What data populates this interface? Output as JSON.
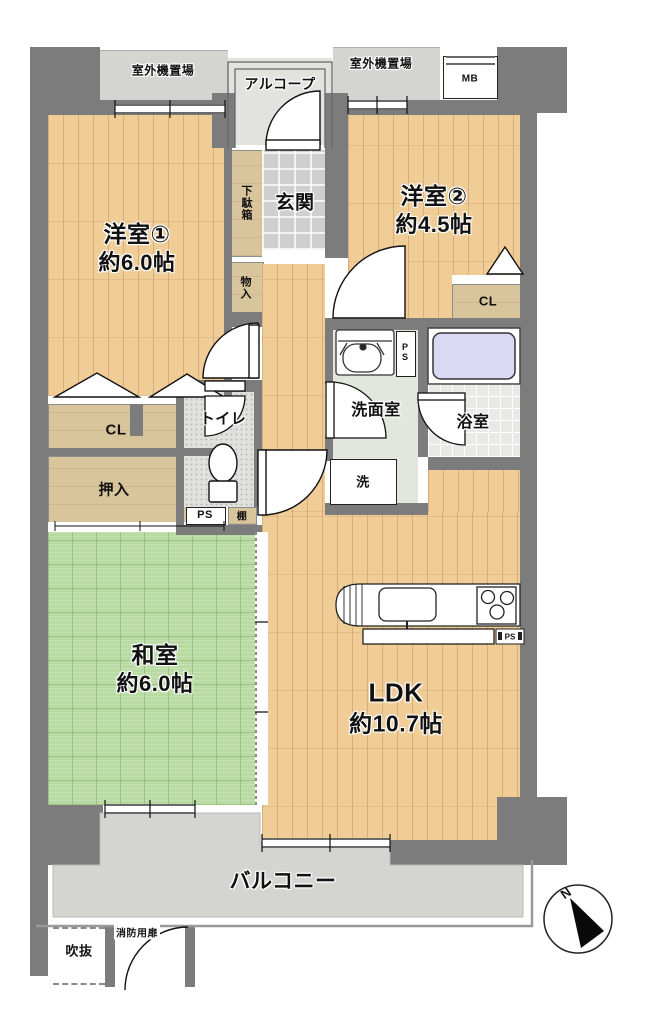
{
  "floorplan": {
    "exterior": {
      "outdoor_unit_left": "室外機置場",
      "outdoor_unit_right": "室外機置場",
      "alcove": "アルコープ",
      "meter_box": "MB",
      "balcony": "バルコニー",
      "open_void": "吹抜",
      "fire_door": "消防用扉"
    },
    "entrance": {
      "genkan": "玄関",
      "shoe_cabinet": "下駄箱",
      "hall_storage": "物入"
    },
    "rooms": {
      "western1": {
        "name": "洋室①",
        "size": "約6.0帖"
      },
      "western2": {
        "name": "洋室②",
        "size": "約4.5帖"
      },
      "japanese": {
        "name": "和室",
        "size": "約6.0帖"
      },
      "ldk": {
        "name": "LDK",
        "size": "約10.7帖"
      }
    },
    "sanitary": {
      "washroom": "洗面室",
      "bathroom": "浴室",
      "toilet": "トイレ",
      "laundry": "洗"
    },
    "storage": {
      "closet_left": "CL",
      "closet_right": "CL",
      "oshiire": "押入",
      "shelf": "棚"
    },
    "pipe_spaces": {
      "ps_toilet": "PS",
      "ps_washroom": "PS",
      "ps_kitchen": "PS"
    },
    "compass": {
      "north": "N"
    },
    "colors": {
      "wall": "#7c7c7c",
      "wood_floor": "#f0cc96",
      "tatami": "#b8dba3",
      "balcony_concrete": "#d4d4d0",
      "entrance_tile": "#cfcfcf",
      "storage_tan": "#d8c59b",
      "bathtub": "#d9d9f3",
      "washroom_floor": "#e2e6dc"
    }
  }
}
